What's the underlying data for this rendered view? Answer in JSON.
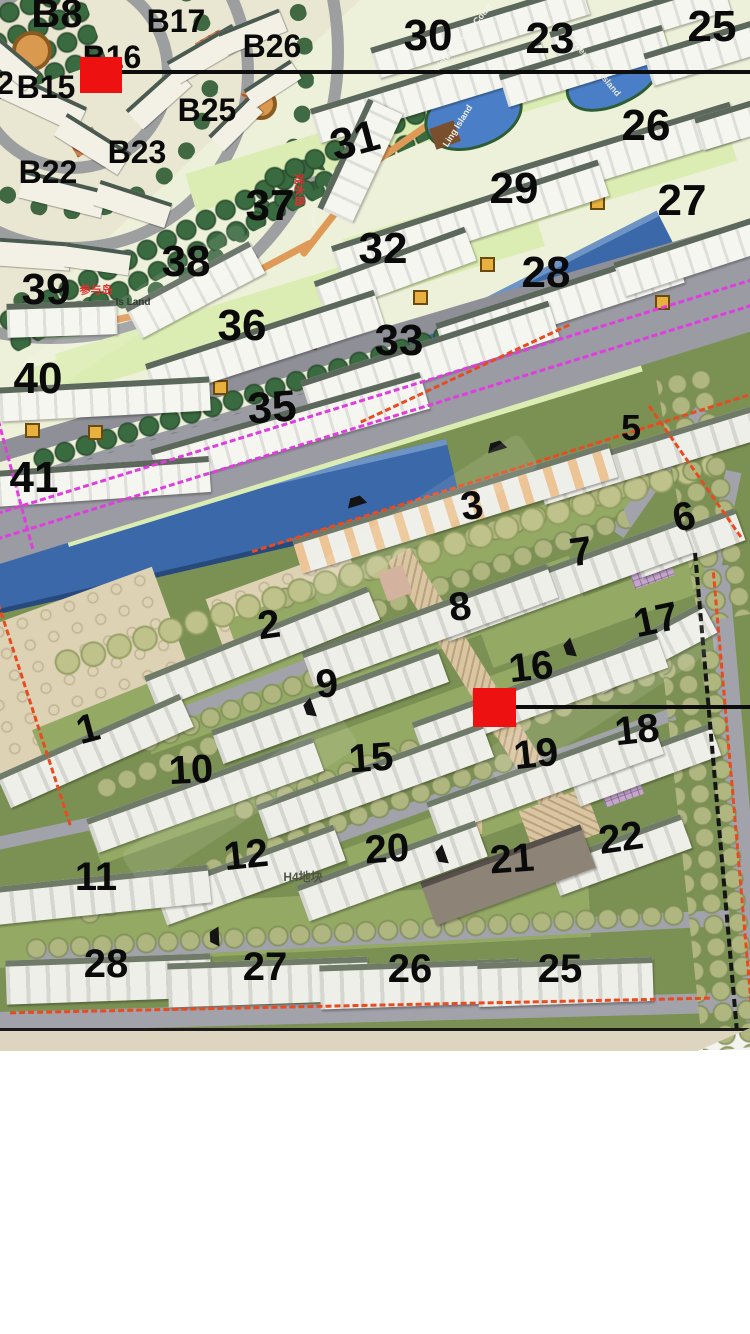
{
  "map": {
    "title": "residential-master-plan",
    "colors": {
      "marker": "#ee1111",
      "river": "#3a68a8",
      "road": "#9b9ba3",
      "upper_ground": "#eef1da",
      "lower_ground": "#7b9153",
      "boundary_red": "#e84b20",
      "boundary_magenta": "#e03ce0",
      "indicator_line": "#0d0d0d"
    },
    "upper_plan": {
      "building_labels": [
        {
          "text": "B8",
          "x": 57,
          "y": 14,
          "size": 40,
          "rot": 0
        },
        {
          "text": "B17",
          "x": 176,
          "y": 21,
          "size": 32,
          "rot": 0
        },
        {
          "text": "B26",
          "x": 272,
          "y": 46,
          "size": 32,
          "rot": 0
        },
        {
          "text": "B16",
          "x": 112,
          "y": 57,
          "size": 32,
          "rot": 0
        },
        {
          "text": "2",
          "x": 5,
          "y": 83,
          "size": 32,
          "rot": 0
        },
        {
          "text": "B15",
          "x": 46,
          "y": 87,
          "size": 32,
          "rot": 0
        },
        {
          "text": "B25",
          "x": 207,
          "y": 110,
          "size": 32,
          "rot": 0
        },
        {
          "text": "B23",
          "x": 137,
          "y": 152,
          "size": 32,
          "rot": 0
        },
        {
          "text": "B22",
          "x": 48,
          "y": 172,
          "size": 32,
          "rot": 0
        },
        {
          "text": "30",
          "x": 428,
          "y": 36,
          "size": 44,
          "rot": 0
        },
        {
          "text": "23",
          "x": 550,
          "y": 39,
          "size": 44,
          "rot": 0
        },
        {
          "text": "25",
          "x": 712,
          "y": 27,
          "size": 44,
          "rot": 0
        },
        {
          "text": "26",
          "x": 646,
          "y": 126,
          "size": 44,
          "rot": 0
        },
        {
          "text": "29",
          "x": 514,
          "y": 189,
          "size": 44,
          "rot": 0
        },
        {
          "text": "27",
          "x": 682,
          "y": 201,
          "size": 44,
          "rot": 0
        },
        {
          "text": "31",
          "x": 355,
          "y": 141,
          "size": 44,
          "rot": -15
        },
        {
          "text": "37",
          "x": 270,
          "y": 206,
          "size": 44,
          "rot": 0
        },
        {
          "text": "32",
          "x": 383,
          "y": 249,
          "size": 44,
          "rot": 0
        },
        {
          "text": "28",
          "x": 546,
          "y": 273,
          "size": 44,
          "rot": 0
        },
        {
          "text": "38",
          "x": 186,
          "y": 262,
          "size": 44,
          "rot": 0
        },
        {
          "text": "39",
          "x": 46,
          "y": 290,
          "size": 44,
          "rot": 0
        },
        {
          "text": "36",
          "x": 242,
          "y": 326,
          "size": 44,
          "rot": 0
        },
        {
          "text": "33",
          "x": 399,
          "y": 341,
          "size": 44,
          "rot": 0
        },
        {
          "text": "40",
          "x": 38,
          "y": 379,
          "size": 44,
          "rot": 0
        },
        {
          "text": "35",
          "x": 272,
          "y": 408,
          "size": 44,
          "rot": -4
        },
        {
          "text": "41",
          "x": 34,
          "y": 478,
          "size": 44,
          "rot": 0
        }
      ],
      "annotations": [
        {
          "text": "参与岛",
          "x": 96,
          "y": 291,
          "size": 11,
          "color": "#e03030",
          "rot": 0
        },
        {
          "text": "Is Land",
          "x": 133,
          "y": 303,
          "size": 10,
          "color": "#2f3a33",
          "rot": 0
        },
        {
          "text": "戏水岛",
          "x": 298,
          "y": 190,
          "size": 11,
          "color": "#e03030",
          "rot": 88
        },
        {
          "text": "Island",
          "x": 313,
          "y": 218,
          "size": 7,
          "color": "#f2f2e8",
          "rot": 88
        },
        {
          "text": "Water Playing Court",
          "x": 463,
          "y": 38,
          "size": 9,
          "color": "#f4f4ec",
          "rot": -50
        },
        {
          "text": "Experience Island",
          "x": 594,
          "y": 66,
          "size": 9,
          "color": "#e6e6da",
          "rot": 50
        },
        {
          "text": "Ling Island",
          "x": 458,
          "y": 126,
          "size": 9,
          "color": "#f0f0e6",
          "rot": -58
        }
      ]
    },
    "lower_plan": {
      "building_labels": [
        {
          "text": "5",
          "x": 631,
          "y": 428,
          "size": 36,
          "rot": 0
        },
        {
          "text": "3",
          "x": 472,
          "y": 506,
          "size": 40,
          "rot": -8
        },
        {
          "text": "6",
          "x": 684,
          "y": 517,
          "size": 40,
          "rot": -12
        },
        {
          "text": "7",
          "x": 581,
          "y": 552,
          "size": 40,
          "rot": -8
        },
        {
          "text": "8",
          "x": 460,
          "y": 607,
          "size": 40,
          "rot": -8
        },
        {
          "text": "2",
          "x": 269,
          "y": 625,
          "size": 40,
          "rot": -8
        },
        {
          "text": "17",
          "x": 656,
          "y": 620,
          "size": 40,
          "rot": -12
        },
        {
          "text": "16",
          "x": 531,
          "y": 667,
          "size": 40,
          "rot": -6
        },
        {
          "text": "9",
          "x": 327,
          "y": 684,
          "size": 40,
          "rot": -5
        },
        {
          "text": "18",
          "x": 637,
          "y": 730,
          "size": 40,
          "rot": -6
        },
        {
          "text": "1",
          "x": 88,
          "y": 729,
          "size": 40,
          "rot": -15
        },
        {
          "text": "19",
          "x": 536,
          "y": 754,
          "size": 40,
          "rot": -6
        },
        {
          "text": "15",
          "x": 371,
          "y": 758,
          "size": 40,
          "rot": -4
        },
        {
          "text": "10",
          "x": 191,
          "y": 770,
          "size": 40,
          "rot": -3
        },
        {
          "text": "22",
          "x": 621,
          "y": 838,
          "size": 40,
          "rot": -8
        },
        {
          "text": "12",
          "x": 246,
          "y": 855,
          "size": 40,
          "rot": -6
        },
        {
          "text": "20",
          "x": 387,
          "y": 849,
          "size": 40,
          "rot": -4
        },
        {
          "text": "21",
          "x": 512,
          "y": 859,
          "size": 40,
          "rot": -4
        },
        {
          "text": "11",
          "x": 96,
          "y": 877,
          "size": 40,
          "rot": 0
        },
        {
          "text": "28",
          "x": 106,
          "y": 964,
          "size": 40,
          "rot": 0
        },
        {
          "text": "27",
          "x": 265,
          "y": 967,
          "size": 40,
          "rot": 0
        },
        {
          "text": "26",
          "x": 410,
          "y": 969,
          "size": 40,
          "rot": 0
        },
        {
          "text": "25",
          "x": 560,
          "y": 969,
          "size": 40,
          "rot": 0
        }
      ],
      "annotations": [
        {
          "text": "H4地块",
          "x": 303,
          "y": 877,
          "size": 12,
          "color": "#4f5443",
          "rot": 0
        }
      ]
    },
    "markers": [
      {
        "name": "selected-building-marker-b16",
        "x": 80,
        "y": 57,
        "w": 42,
        "h": 36,
        "line": {
          "y": 70,
          "x1": 116,
          "x2": 750,
          "t": 4
        }
      },
      {
        "name": "selected-building-marker-16",
        "x": 473,
        "y": 688,
        "w": 43,
        "h": 39,
        "line": {
          "y": 705,
          "x1": 513,
          "x2": 750,
          "t": 4
        }
      }
    ]
  }
}
